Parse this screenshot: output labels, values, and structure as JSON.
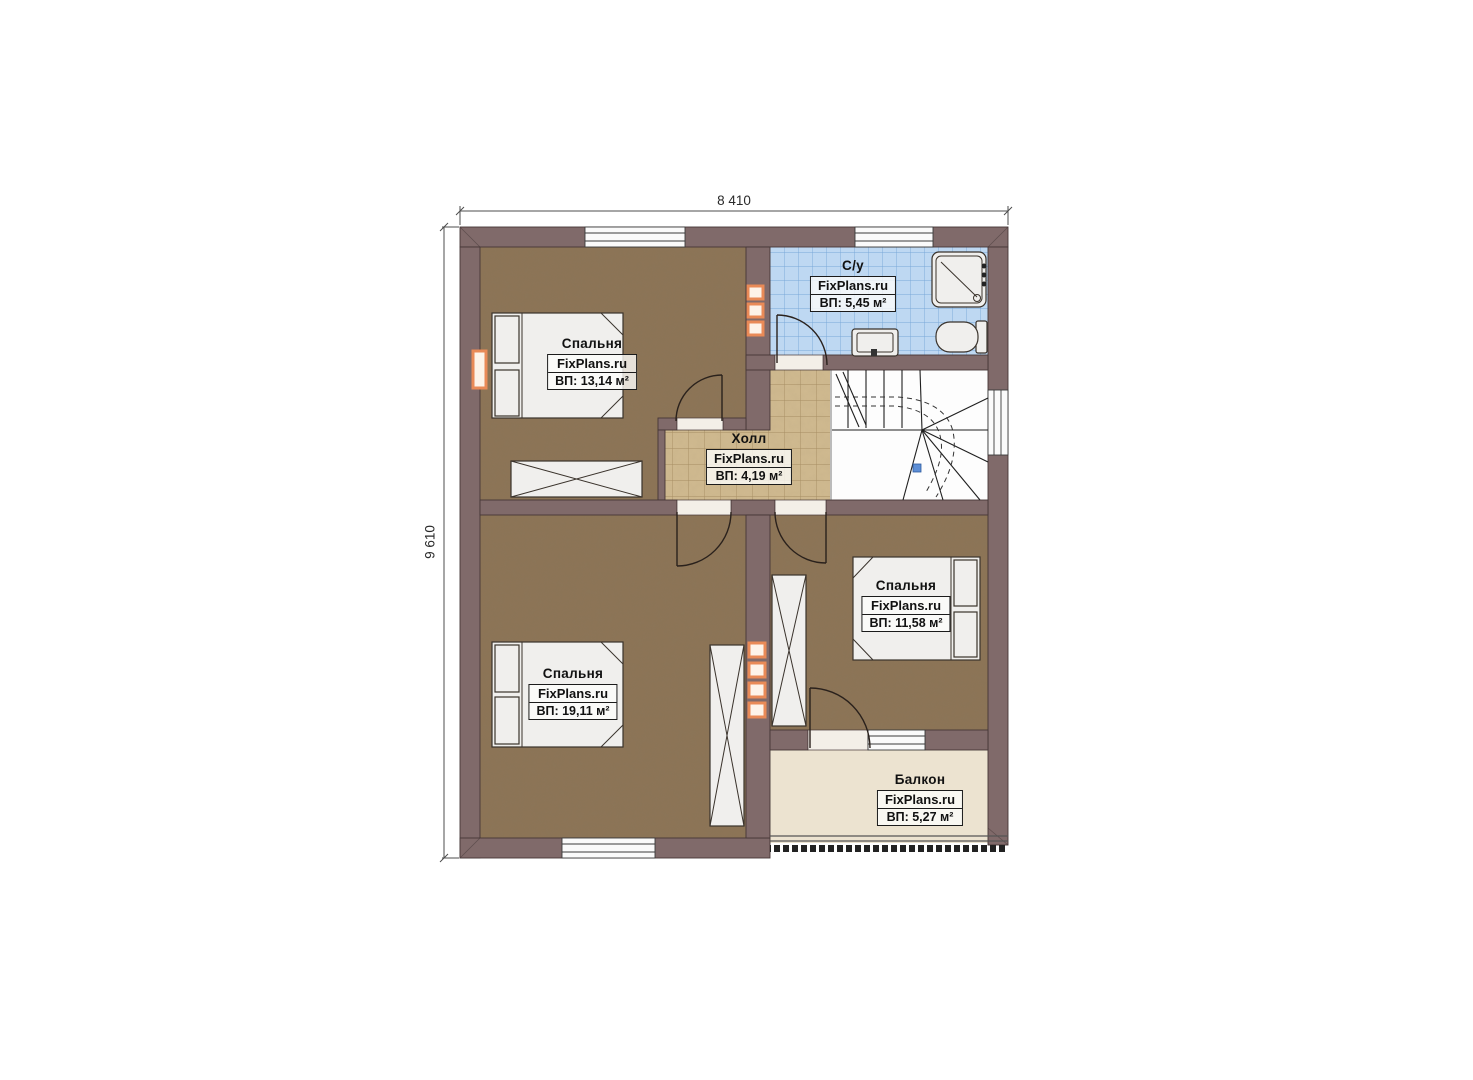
{
  "dimensions": {
    "width_label": "8 410",
    "height_label": "9 610"
  },
  "rooms": [
    {
      "id": "bedroom-top-left",
      "name": "Спальня",
      "watermark": "FixPlans.ru",
      "area": "ВП: 13,14 м²"
    },
    {
      "id": "bathroom",
      "name": "С/у",
      "watermark": "FixPlans.ru",
      "area": "ВП: 5,45 м²"
    },
    {
      "id": "hall",
      "name": "Холл",
      "watermark": "FixPlans.ru",
      "area": "ВП: 4,19 м²"
    },
    {
      "id": "bedroom-bottom-left",
      "name": "Спальня",
      "watermark": "FixPlans.ru",
      "area": "ВП: 19,11 м²"
    },
    {
      "id": "bedroom-bottom-right",
      "name": "Спальня",
      "watermark": "FixPlans.ru",
      "area": "ВП: 11,58 м²"
    },
    {
      "id": "balcony",
      "name": "Балкон",
      "watermark": "FixPlans.ru",
      "area": "ВП: 5,27 м²"
    }
  ],
  "colors": {
    "wall": "#806a6a",
    "bedroom_floor": "#8c7456",
    "hall_floor": "#d0ba90",
    "bathroom_floor": "#bed8f2",
    "balcony_floor": "#ece3d0",
    "accent_orange": "#e98a57"
  }
}
